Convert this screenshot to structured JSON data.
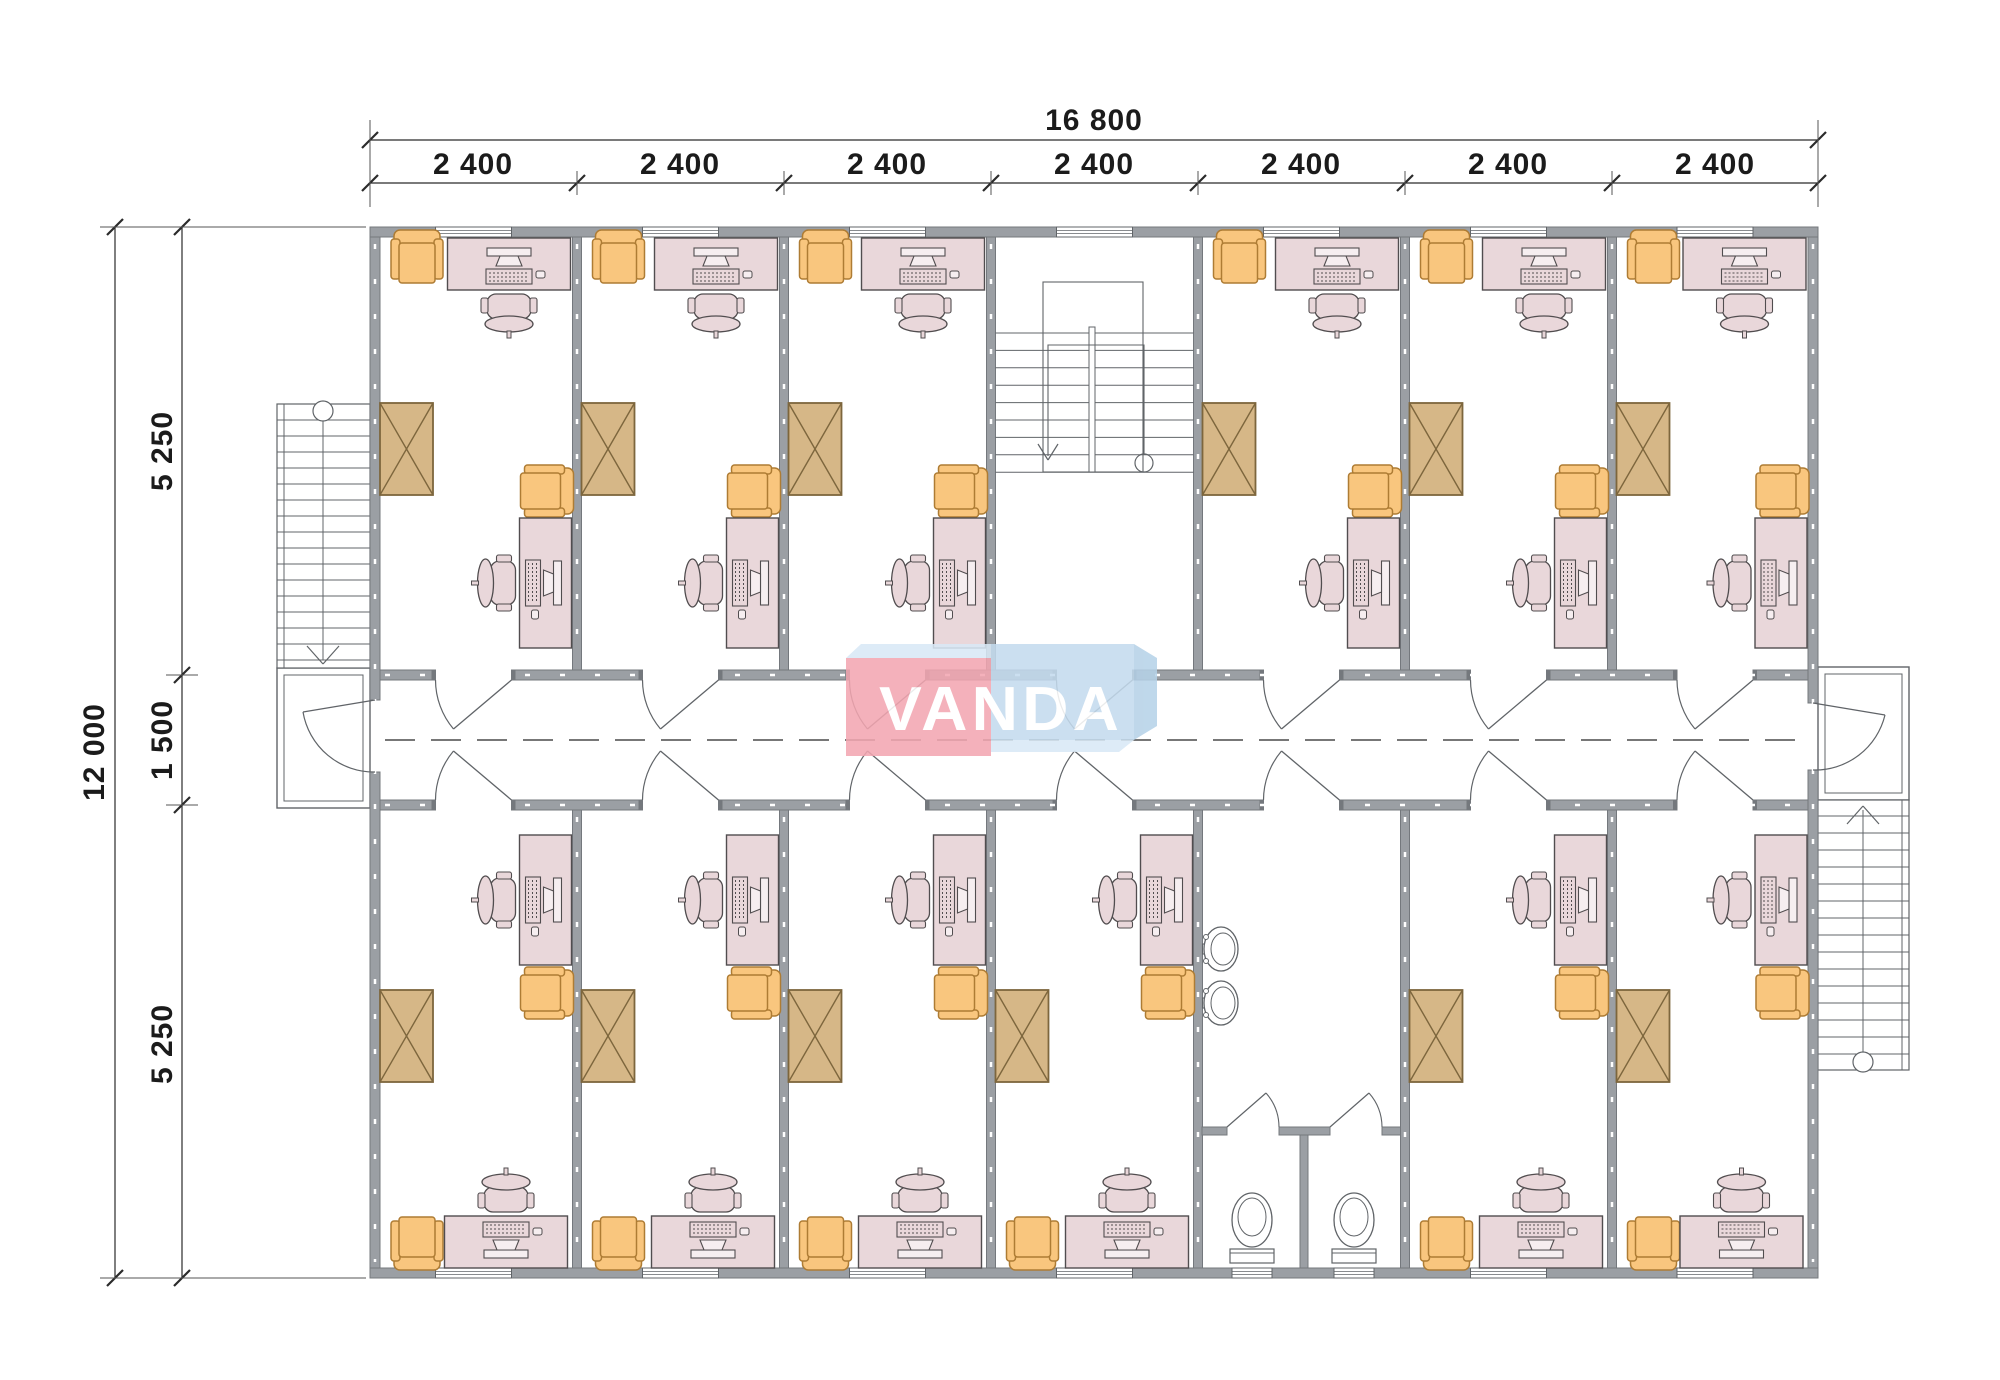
{
  "dimensions": {
    "top": {
      "total": "16 800",
      "bays": [
        "2 400",
        "2 400",
        "2 400",
        "2 400",
        "2 400",
        "2 400",
        "2 400"
      ]
    },
    "left": {
      "total": "12 000",
      "segments": [
        "5 250",
        "1 500",
        "5 250"
      ]
    }
  },
  "logo": {
    "text": "VANDA",
    "pink": "#f3a6b1",
    "blue": "#c4dbee",
    "bevel_light": "#d9e9f6",
    "bevel_mid": "#b6d2e8",
    "text_color": "#ffffff"
  },
  "plan": {
    "colors": {
      "wall": "#9b9fa4",
      "wall_edge": "#74787d",
      "wall_tick": "#ffffff",
      "line": "#606468",
      "furniture": "#514d4f",
      "desk_fill": "#e9d7da",
      "desk_light": "#f6eef0",
      "orange_fill": "#f9c67e",
      "orange_edge": "#ae7c34",
      "wardrobe_fill": "#d6b787",
      "wardrobe_edge": "#7d663d",
      "dim": "#2b2b2b"
    },
    "geometry": {
      "outline": {
        "left": 370,
        "right": 1818,
        "top": 227,
        "bottom": 1278,
        "wall": 10
      },
      "bays": [
        370,
        577,
        784,
        991,
        1198,
        1405,
        1612,
        1818
      ],
      "corridor": {
        "top": 670,
        "bottom": 810,
        "wall": 10,
        "center_y": 740,
        "door_width": 76
      },
      "rows": {
        "top_rooms": [
          0,
          1,
          2,
          4,
          5,
          6
        ],
        "stair_bay": 3,
        "bottom_rooms": [
          0,
          1,
          2,
          3,
          5,
          6
        ],
        "washroom_bay": 4
      },
      "window_width": 76
    }
  }
}
